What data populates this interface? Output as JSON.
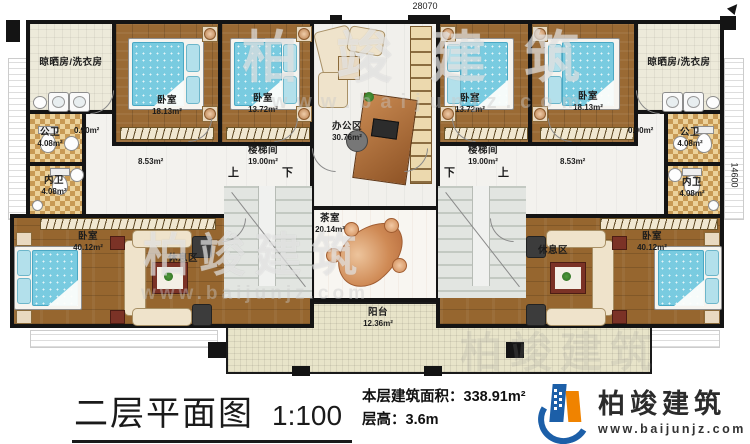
{
  "rooms": {
    "laundry_left": {
      "name": "晾晒房/洗衣房"
    },
    "bedroom_tl1": {
      "name": "卧室",
      "area": "18.13m²"
    },
    "bedroom_tl2": {
      "name": "卧室",
      "area": "13.72m²"
    },
    "office": {
      "name": "办公区",
      "area": "30.76m²"
    },
    "bedroom_tr2": {
      "name": "卧室",
      "area": "13.72m²"
    },
    "bedroom_tr1": {
      "name": "卧室",
      "area": "18.13m²"
    },
    "laundry_right": {
      "name": "晾晒房/洗衣房"
    },
    "pub_bath_left": {
      "name": "公卫",
      "area": "4.08m²"
    },
    "priv_bath_left": {
      "name": "内卫",
      "area": "4.08m²"
    },
    "pub_bath_right": {
      "name": "公卫",
      "area": "4.08m²"
    },
    "priv_bath_right": {
      "name": "内卫",
      "area": "4.08m²"
    },
    "corridor_left": {
      "area": "0.90m²"
    },
    "corridor_right": {
      "area": "0.90m²"
    },
    "hall_left": {
      "area": "8.53m²"
    },
    "hall_right": {
      "area": "8.53m²"
    },
    "stair_left": {
      "name": "楼梯间",
      "area": "19.00m²"
    },
    "stair_right": {
      "name": "楼梯间",
      "area": "19.00m²"
    },
    "tea_room": {
      "name": "茶室",
      "area": "20.14m²"
    },
    "bedroom_bl": {
      "name": "卧室",
      "area": "40.12m²"
    },
    "rest_left": {
      "name": "休息区"
    },
    "bedroom_br": {
      "name": "卧室",
      "area": "40.12m²"
    },
    "rest_right": {
      "name": "休息区"
    },
    "balcony": {
      "name": "阳台",
      "area": "12.36m²"
    }
  },
  "stairs": {
    "up": "上",
    "down": "下"
  },
  "dimensions": {
    "top": "28070",
    "right": "14600"
  },
  "footer": {
    "title": "二层平面图",
    "scale": "1:100",
    "area_line": "本层建筑面积：338.91m²",
    "height_line": "层高：3.6m"
  },
  "brand": {
    "name": "柏竣建筑",
    "website": "www.baijunjz.com"
  },
  "watermark": {
    "name": "柏竣建筑",
    "website": "www.baijunjz.com"
  },
  "colors": {
    "wall": "#141414",
    "wood_floor": "#9a6a34",
    "bed_blue": "#79cbe0",
    "bath_checker": "#c89a55",
    "balcony_tan": "#e8e4c9",
    "logo_blue": "#1c5fa8",
    "logo_orange": "#f08300"
  }
}
